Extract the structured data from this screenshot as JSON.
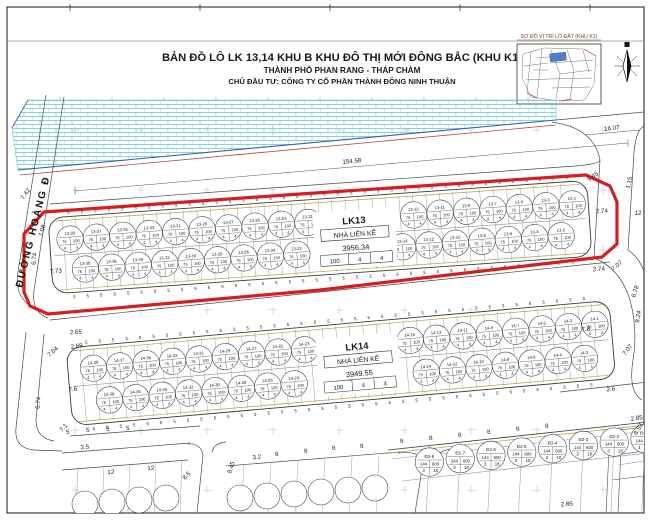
{
  "page": {
    "title1": "BẢN ĐỒ LÔ LK 13,14 KHU B KHU ĐÔ THỊ MỚI ĐÔNG BẮC (KHU K1)",
    "title2": "THÀNH PHỐ PHAN RANG - THÁP CHÀM",
    "title3": "CHỦ ĐẦU TƯ: CÔNG TY CỔ PHẦN THÀNH ĐÔNG NINH THUẬN",
    "inset_caption": "SƠ ĐỒ VỊ TRÍ LÔ ĐẤT (KHU K1)"
  },
  "street_left_label": "ĐƯỜNG HOÀNG Đ",
  "strips": [
    {
      "id": "lk13",
      "name": "LK13",
      "type": "NHÀ LIÊN KẾ",
      "area": "3956.34",
      "table": [
        "100",
        "4",
        "4"
      ],
      "tick": "5",
      "circle": {
        "tl": "75",
        "tr": "100",
        "bl": "4",
        "br": "4"
      },
      "codes": [
        "13-1",
        "13-2",
        "13-3",
        "13-4",
        "13-5",
        "13-6",
        "13-7",
        "13-8",
        "13-9",
        "13-10",
        "13-11",
        "13-12",
        "13-13",
        "13-14",
        "13-15",
        "13-16",
        "13-17",
        "13-18",
        "13-19",
        "13-20",
        "13-21",
        "13-22",
        "13-23",
        "13-24",
        "13-25",
        "13-26",
        "13-27",
        "13-28",
        "13-29",
        "13-30",
        "13-31",
        "13-32",
        "13-33",
        "13-34",
        "13-35",
        "13-36",
        "13-37",
        "13-38",
        "13-39",
        "13-40"
      ]
    },
    {
      "id": "lk14",
      "name": "LK14",
      "type": "NHÀ LIÊN KẾ",
      "area": "3949.55",
      "table": [
        "100",
        "4",
        "4"
      ],
      "tick": "5",
      "circle": {
        "tl": "75",
        "tr": "100",
        "bl": "4",
        "br": "4"
      },
      "codes": [
        "14-1",
        "14-2",
        "14-3",
        "14-4",
        "14-5",
        "14-6",
        "14-7",
        "14-8",
        "14-9",
        "14-10",
        "14-11",
        "14-12",
        "14-13",
        "14-14",
        "14-15",
        "14-16",
        "14-17",
        "14-18",
        "14-19",
        "14-20",
        "14-21",
        "14-22",
        "14-23",
        "14-24",
        "14-25",
        "14-26",
        "14-27",
        "14-28",
        "14-29",
        "14-30",
        "14-31",
        "14-32",
        "14-33",
        "14-34",
        "14-35",
        "14-36",
        "14-37",
        "14-38",
        "14-39",
        "14-40"
      ]
    }
  ],
  "bottom_block": {
    "tick": "8",
    "circle": {
      "tl": "144",
      "tr": "600",
      "bl": "3",
      "br": "18"
    },
    "codes": [
      "Đ2-1",
      "Đ2-2",
      "Đ2-3",
      "Đ2-4",
      "Đ2-5",
      "Đ2-6",
      "Đ2-7",
      "Đ2-8"
    ]
  },
  "dimensions": [
    {
      "t": "154.58",
      "x": 352,
      "y": 163,
      "r": -5
    },
    {
      "t": "16.07",
      "x": 612,
      "y": 130,
      "r": -7
    },
    {
      "t": "7.42",
      "x": 27,
      "y": 195,
      "r": -55
    },
    {
      "t": "1.15",
      "x": 631,
      "y": 183,
      "r": -78
    },
    {
      "t": "12",
      "x": 638,
      "y": 215,
      "r": 0
    },
    {
      "t": "9.45",
      "x": 594,
      "y": 178,
      "r": -35
    },
    {
      "t": "2.74",
      "x": 602,
      "y": 213,
      "r": -4
    },
    {
      "t": "2.74",
      "x": 599,
      "y": 271,
      "r": -4
    },
    {
      "t": "2.65",
      "x": 76,
      "y": 334,
      "r": -4
    },
    {
      "t": "7.73",
      "x": 56,
      "y": 273,
      "r": -4
    },
    {
      "t": "7.08",
      "x": 44,
      "y": 231,
      "r": -75
    },
    {
      "t": "6.74",
      "x": 36,
      "y": 259,
      "r": -85
    },
    {
      "t": "7.04",
      "x": 54,
      "y": 353,
      "r": -42
    },
    {
      "t": "2.69",
      "x": 77,
      "y": 348,
      "r": -8
    },
    {
      "t": "7.6",
      "x": 73,
      "y": 391,
      "r": -4
    },
    {
      "t": "6.74",
      "x": 40,
      "y": 403,
      "r": -85
    },
    {
      "t": "7.1",
      "x": 65,
      "y": 429,
      "r": -48
    },
    {
      "t": "7.07",
      "x": 618,
      "y": 267,
      "r": -38
    },
    {
      "t": "6.78",
      "x": 637,
      "y": 292,
      "r": -72
    },
    {
      "t": "8.24",
      "x": 640,
      "y": 317,
      "r": -80
    },
    {
      "t": "7.07",
      "x": 629,
      "y": 351,
      "r": -52
    },
    {
      "t": "7.8",
      "x": 586,
      "y": 331,
      "r": -5
    },
    {
      "t": "2.6",
      "x": 611,
      "y": 391,
      "r": -5
    },
    {
      "t": "2.85",
      "x": 637,
      "y": 420,
      "r": -8
    },
    {
      "t": "8.53",
      "x": 640,
      "y": 430,
      "r": -60
    },
    {
      "t": "2.85",
      "x": 567,
      "y": 506,
      "r": -5
    },
    {
      "t": "2.5",
      "x": 85,
      "y": 449,
      "r": -5
    },
    {
      "t": "12",
      "x": 111,
      "y": 474,
      "r": -4
    },
    {
      "t": "12",
      "x": 151,
      "y": 470,
      "r": -4
    },
    {
      "t": "8.5",
      "x": 188,
      "y": 477,
      "r": -45
    },
    {
      "t": "8.45",
      "x": 233,
      "y": 468,
      "r": -72
    },
    {
      "t": "3.2",
      "x": 257,
      "y": 459,
      "r": -6
    },
    {
      "t": "8",
      "x": 277,
      "y": 456,
      "r": -6
    },
    {
      "t": "8",
      "x": 306,
      "y": 453,
      "r": -6
    },
    {
      "t": "8",
      "x": 334,
      "y": 450,
      "r": -6
    },
    {
      "t": "8",
      "x": 362,
      "y": 448,
      "r": -6
    },
    {
      "t": "8",
      "x": 402,
      "y": 443,
      "r": -6
    },
    {
      "t": "8",
      "x": 431,
      "y": 440,
      "r": -6
    },
    {
      "t": "8",
      "x": 460,
      "y": 437,
      "r": -6
    },
    {
      "t": "8",
      "x": 489,
      "y": 434,
      "r": -6
    },
    {
      "t": "8",
      "x": 518,
      "y": 431,
      "r": -6
    },
    {
      "t": "8",
      "x": 547,
      "y": 428,
      "r": -6
    },
    {
      "t": "5",
      "x": 68,
      "y": 434,
      "r": -5
    },
    {
      "t": "5",
      "x": 88,
      "y": 432,
      "r": -5
    },
    {
      "t": "5",
      "x": 108,
      "y": 431,
      "r": -5
    },
    {
      "t": "5",
      "x": 128,
      "y": 430,
      "r": -5
    }
  ],
  "colors": {
    "boundary_red": "#d51f1f",
    "thin_red": "#c0443a",
    "hatch_cyan": "#62c6c6",
    "water_blue": "#3a5fb0",
    "tan": "#c09a4a",
    "purple": "#8d8dc2",
    "inset_lot_blue": "#5080c8",
    "grid": "#b5c2d8"
  }
}
